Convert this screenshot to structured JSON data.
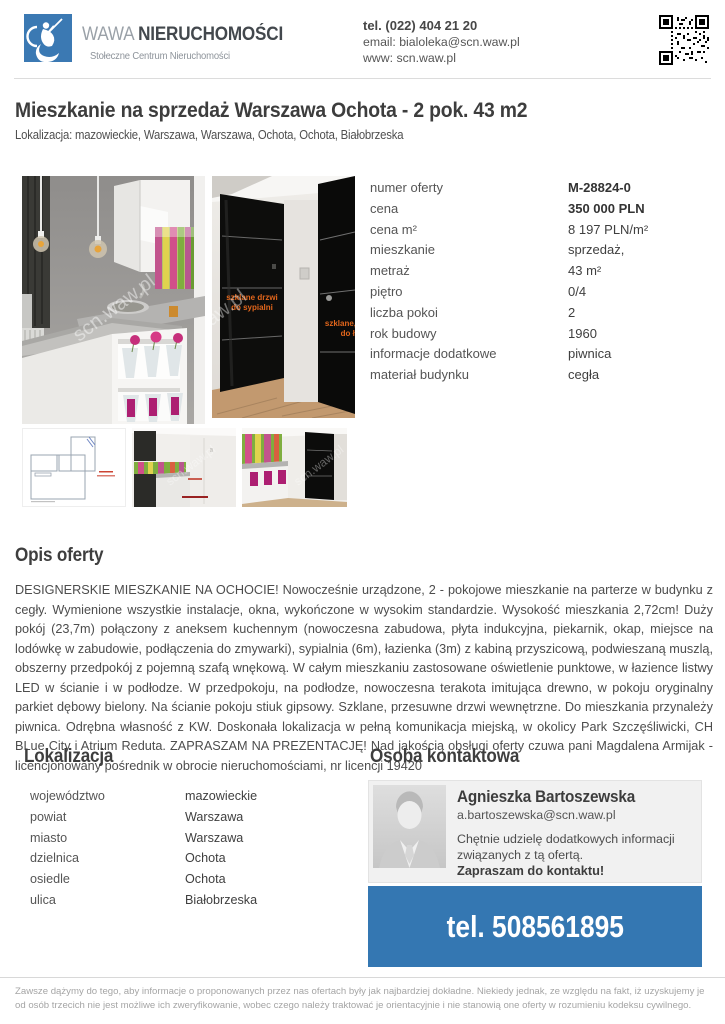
{
  "brand": {
    "word_light": "WAWA ",
    "word_bold": "NIERUCHOMOŚCI",
    "tagline": "Stołeczne Centrum Nieruchomości"
  },
  "header_contact": {
    "phone": "tel. (022) 404 21 20",
    "email": "email: bialoleka@scn.waw.pl",
    "www": "www: scn.waw.pl"
  },
  "listing": {
    "title": "Mieszkanie na sprzedaż Warszawa Ochota - 2 pok. 43 m2",
    "location_line": "Lokalizacja: mazowieckie, Warszawa, Warszawa, Ochota, Ochota, Białobrzeska"
  },
  "details": {
    "rows": [
      {
        "label": "numer oferty",
        "value": "M-28824-0"
      },
      {
        "label": "cena",
        "value": "350 000 PLN"
      },
      {
        "label": "cena m²",
        "value": "8 197 PLN/m²"
      },
      {
        "label": "mieszkanie",
        "value": "sprzedaż,"
      },
      {
        "label": "metraż",
        "value": "43 m²"
      },
      {
        "label": "piętro",
        "value": "0/4"
      },
      {
        "label": "liczba pokoi",
        "value": "2"
      },
      {
        "label": "rok budowy",
        "value": "1960"
      },
      {
        "label": "informacje dodatkowe",
        "value": "piwnica"
      },
      {
        "label": "materiał budynku",
        "value": "cegła"
      }
    ]
  },
  "photos": {
    "watermark": "scn.waw.pl",
    "annotations": {
      "door1_line1": "szklane drzwi",
      "door1_line2": "do sypialni",
      "door2_line1": "szklane, p",
      "door2_line2": "do ła"
    }
  },
  "description": {
    "heading": "Opis oferty",
    "text": "DESIGNERSKIE MIESZKANIE NA OCHOCIE! Nowocześnie urządzone, 2 - pokojowe mieszkanie na parterze w budynku z cegły. Wymienione wszystkie instalacje, okna, wykończone w wysokim standardzie. Wysokość mieszkania 2,72cm! Duży pokój (23,7m) połączony z aneksem kuchennym (nowoczesna zabudowa, płyta indukcyjna, piekarnik, okap, miejsce na lodówkę w zabudowie, podłączenia do zmywarki), sypialnia (6m), łazienka (3m) z kabiną przyszicową, podwieszaną muszlą, obszerny przedpokój z pojemną szafą wnękową. W całym mieszkaniu zastosowane oświetlenie punktowe, w łazience listwy LED w ścianie i w podłodze. W przedpokoju, na podłodze, nowoczesna terakota imitująca drewno, w pokoju oryginalny parkiet dębowy bielony. Na ścianie pokoju stiuk gipsowy. Szklane, przesuwne drzwi wewnętrzne. Do mieszkania przynależy piwnica. Odrębna własność z KW. Doskonała lokalizacja w pełną komunikacja miejską, w okolicy Park Szczęśliwicki, CH BLue City i Atrium Reduta. ZAPRASZAM NA PREZENTACJĘ! Nad jakością obsługi oferty czuwa pani Magdalena Armijak - licencjonowany pośrednik w obrocie nieruchomościami, nr licencji 19420"
  },
  "location": {
    "heading": "Lokalizacja",
    "rows": [
      {
        "label": "województwo",
        "value": "mazowieckie"
      },
      {
        "label": "powiat",
        "value": "Warszawa"
      },
      {
        "label": "miasto",
        "value": "Warszawa"
      },
      {
        "label": "dzielnica",
        "value": "Ochota"
      },
      {
        "label": "osiedle",
        "value": "Ochota"
      },
      {
        "label": "ulica",
        "value": "Białobrzeska"
      }
    ]
  },
  "agent": {
    "heading": "Osoba kontaktowa",
    "name": "Agnieszka Bartoszewska",
    "email": "a.bartoszewska@scn.waw.pl",
    "line1": "Chętnie udzielę dodatkowych informacji",
    "line2": "związanych z tą ofertą.",
    "cta": "Zapraszam do kontaktu!",
    "phone": "tel. 508561895"
  },
  "footer": {
    "disclaimer": "Zawsze dążymy do tego, aby informacje o proponowanych przez nas ofertach były jak najbardziej dokładne. Niekiedy jednak, ze względu na fakt, iż uzyskujemy je od osób trzecich nie jest możliwe ich zweryfikowanie, wobec czego należy traktować je orientacyjnie i nie stanowią one oferty w rozumieniu kodeksu cywilnego.",
    "colors": {
      "accent_blue": "#3477b2",
      "annotation_orange": "#e2661c"
    }
  }
}
